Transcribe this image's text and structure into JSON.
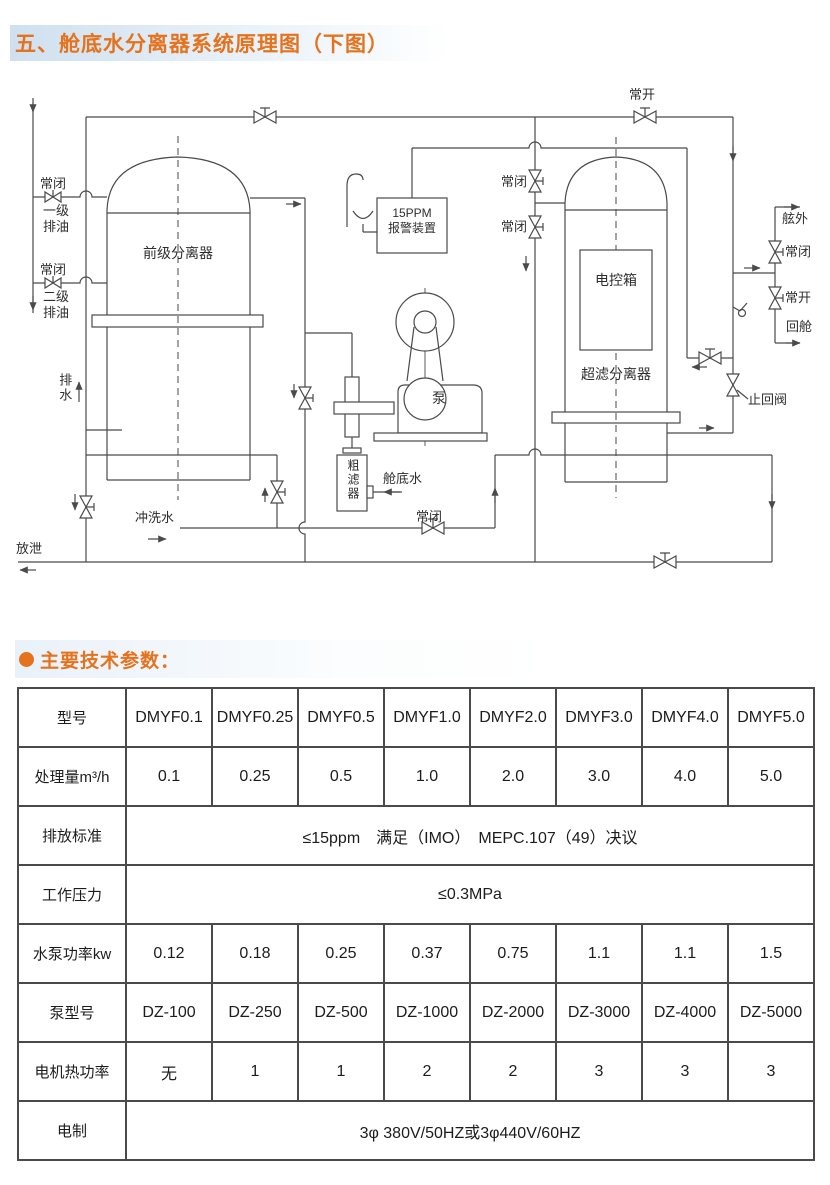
{
  "page": {
    "title": "五、舱底水分离器系统原理图（下图）",
    "section_heading": "主要技术参数："
  },
  "diagram": {
    "labels": {
      "normally_closed": "常闭",
      "normally_open": "常开",
      "stage1_oil_drain": "一级排油",
      "stage2_oil_drain": "二级排油",
      "drain_water": "排水",
      "pre_separator": "前级分离器",
      "alarm_line1": "15PPM",
      "alarm_line2": "报警装置",
      "pump": "泵",
      "coarse_filter": "粗滤器",
      "bilge_water": "舱底水",
      "flush_water": "冲洗水",
      "discharge": "放泄",
      "control_box": "电控箱",
      "uf_separator": "超滤分离器",
      "overboard": "舷外",
      "return_to_tank": "回舱",
      "check_valve": "止回阀"
    }
  },
  "table": {
    "rows": [
      {
        "label": "型号",
        "cells": [
          "DMYF0.1",
          "DMYF0.25",
          "DMYF0.5",
          "DMYF1.0",
          "DMYF2.0",
          "DMYF3.0",
          "DMYF4.0",
          "DMYF5.0"
        ]
      },
      {
        "label": "处理量m³/h",
        "cells": [
          "0.1",
          "0.25",
          "0.5",
          "1.0",
          "2.0",
          "3.0",
          "4.0",
          "5.0"
        ]
      },
      {
        "label": "排放标准",
        "merged": "≤15ppm　满足（IMO）　MEPC.107（49）决议"
      },
      {
        "label": "工作压力",
        "merged": "≤0.3MPa"
      },
      {
        "label": "水泵功率kw",
        "cells": [
          "0.12",
          "0.18",
          "0.25",
          "0.37",
          "0.75",
          "1.1",
          "1.1",
          "1.5"
        ]
      },
      {
        "label": "泵型号",
        "cells": [
          "DZ-100",
          "DZ-250",
          "DZ-500",
          "DZ-1000",
          "DZ-2000",
          "DZ-3000",
          "DZ-4000",
          "DZ-5000"
        ]
      },
      {
        "label": "电机热功率",
        "cells": [
          "无",
          "1",
          "1",
          "2",
          "2",
          "3",
          "3",
          "3"
        ]
      },
      {
        "label": "电制",
        "merged": "3φ 380V/50HZ或3φ440V/60HZ"
      }
    ]
  },
  "colors": {
    "accent": "#e5731e",
    "diagram_line": "#4a4a4a",
    "table_border": "#4a4a4a"
  }
}
